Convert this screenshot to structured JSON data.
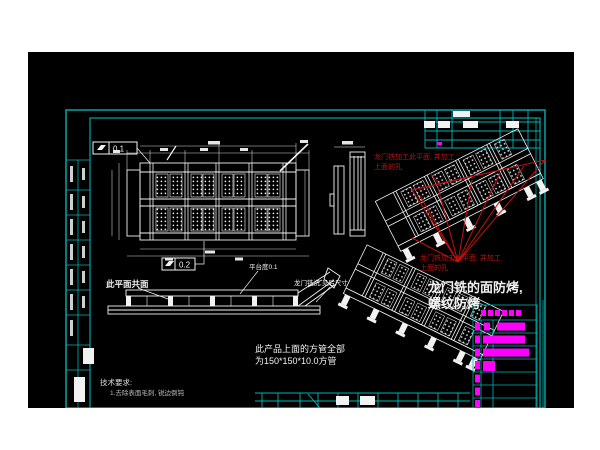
{
  "app": {
    "type": "cad-drawing-viewer",
    "canvas_background": "#000000",
    "page_background": "#ffffff"
  },
  "colors": {
    "frame_cyan": "#00b5b5",
    "line_white": "#f2f2f2",
    "annotation_red": "#c41111",
    "highlight_magenta": "#ff00ff"
  },
  "annotations": {
    "red_note_top": {
      "line1": "龙门铣加工此平面, 并加工",
      "line2": "上面的孔"
    },
    "red_note_bottom": {
      "line1": "龙门铣加工此平面, 并加工",
      "line2": "上面的孔"
    },
    "milling_note": {
      "line1": "龙门铣的面防烤,",
      "line2": "螺纹防烤"
    },
    "tube_note": {
      "line1": "此产品上面的方管全部",
      "line2": "为150*150*10.0方管"
    },
    "coplanar_note": "此平面共面",
    "flatness_callout": "平台度0.1",
    "gantry_size_note": "龙门铣洗,见后尺寸",
    "tech_requirements": {
      "title": "技术要求:",
      "item1": "1.去除表面毛刺, 锐边倒钝"
    },
    "gdt_top_value": "0.1",
    "gdt_mid_value": "0.2"
  },
  "parts_table": {
    "header_glyphs": 6,
    "rows": [
      {
        "cells": 2,
        "bar_width": 28
      },
      {
        "cells": 1,
        "bar_width": 42
      },
      {
        "cells": 1,
        "bar_width": 46
      },
      {
        "cells": 1,
        "bar_width": 12
      },
      {
        "cells": 1,
        "bar_width": 0
      },
      {
        "cells": 1,
        "bar_width": 0
      },
      {
        "cells": 1,
        "bar_width": 0
      }
    ]
  },
  "views": {
    "plan_view": "top plan view of gantry frame with perforated panels",
    "side_view": "narrow section view",
    "elevation_view": "front elevation with diagonal arm",
    "iso_view_marked": "isometric view with red machining web",
    "iso_view_plain": "isometric view"
  }
}
